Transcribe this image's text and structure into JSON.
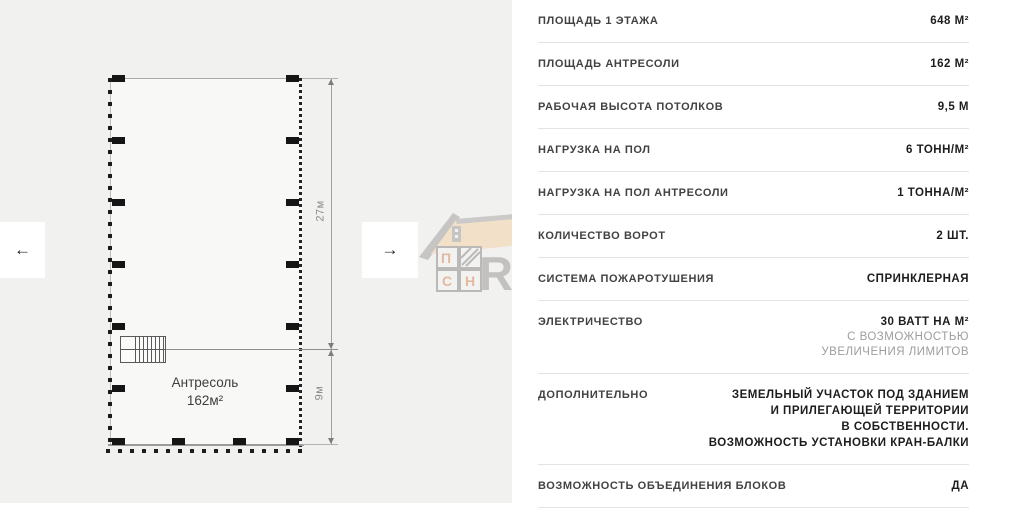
{
  "plan": {
    "mezzanine_label": "Антресоль",
    "mezzanine_area": "162м²",
    "dim_main": "27м",
    "dim_mezzanine": "9м",
    "prev_arrow": "←",
    "next_arrow": "→"
  },
  "watermark": {
    "grid_letter_1": "П",
    "grid_letter_2": "С",
    "grid_letter_3": "Н",
    "brand_text": "REALTY",
    "roof_color": "#f3d3a9",
    "gray_color": "#a5a29f",
    "letter_color": "#d98c5c"
  },
  "specs": {
    "rows": [
      {
        "label": "ПЛОЩАДЬ 1 ЭТАЖА",
        "value": "648 М²"
      },
      {
        "label": "ПЛОЩАДЬ АНТРЕСОЛИ",
        "value": "162 М²"
      },
      {
        "label": "РАБОЧАЯ ВЫСОТА ПОТОЛКОВ",
        "value": "9,5 М"
      },
      {
        "label": "НАГРУЗКА НА ПОЛ",
        "value": "6 ТОНН/М²"
      },
      {
        "label": "НАГРУЗКА НА ПОЛ АНТРЕСОЛИ",
        "value": "1 ТОННА/М²"
      },
      {
        "label": "КОЛИЧЕСТВО ВОРОТ",
        "value": "2 ШТ."
      },
      {
        "label": "СИСТЕМА ПОЖАРОТУШЕНИЯ",
        "value": "СПРИНКЛЕРНАЯ"
      },
      {
        "label": "ЭЛЕКТРИЧЕСТВО",
        "value": "30 ВАТТ НА М²",
        "note_lines": [
          "С ВОЗМОЖНОСТЬЮ",
          "УВЕЛИЧЕНИЯ ЛИМИТОВ"
        ]
      },
      {
        "label": "ДОПОЛНИТЕЛЬНО",
        "value_lines": [
          "ЗЕМЕЛЬНЫЙ УЧАСТОК ПОД ЗДАНИЕМ",
          "И ПРИЛЕГАЮЩЕЙ ТЕРРИТОРИИ",
          "В СОБСТВЕННОСТИ.",
          "ВОЗМОЖНОСТЬ УСТАНОВКИ КРАН-БАЛКИ"
        ]
      },
      {
        "label": "ВОЗМОЖНОСТЬ ОБЪЕДИНЕНИЯ БЛОКОВ",
        "value": "ДА"
      }
    ]
  }
}
